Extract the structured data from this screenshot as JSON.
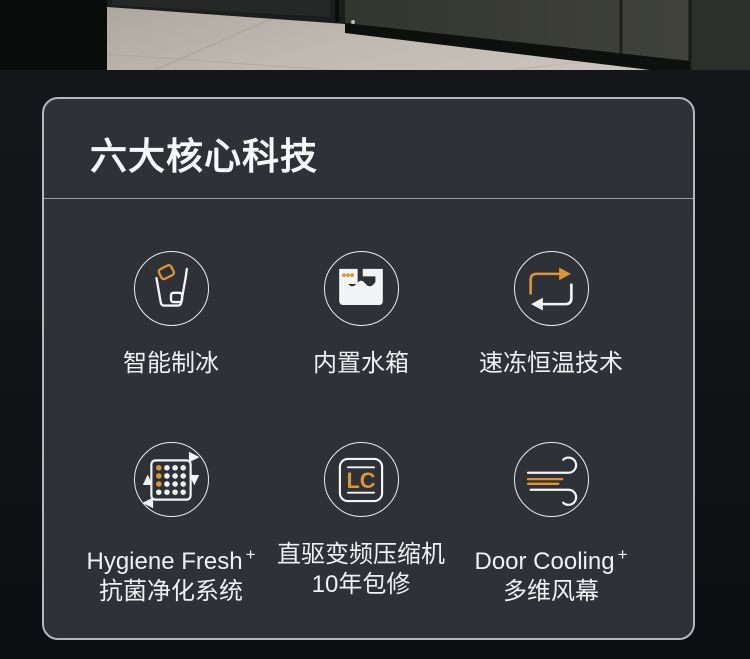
{
  "colors": {
    "accent_orange": "#dd9434",
    "icon_white": "#f2f4f5"
  },
  "section": {
    "title": "六大核心科技",
    "features": [
      {
        "name": "smart-ice-making",
        "icon": "ice-bucket-icon",
        "label": "智能制冰",
        "label_sup": "",
        "sub": ""
      },
      {
        "name": "built-in-water-tank",
        "icon": "water-tank-icon",
        "label": "内置水箱",
        "label_sup": "",
        "sub": ""
      },
      {
        "name": "quick-freeze-constant-temp",
        "icon": "cycle-arrows-icon",
        "label": "速冻恒温技术",
        "label_sup": "",
        "sub": ""
      },
      {
        "name": "hygiene-fresh-system",
        "icon": "air-filter-icon",
        "label": "Hygiene Fresh",
        "label_sup": "+",
        "sub": "抗菌净化系统"
      },
      {
        "name": "inverter-compressor",
        "icon": "lc-compressor-icon",
        "icon_text": "LC",
        "label": "直驱变频压缩机",
        "label_sup": "",
        "sub": "10年包修"
      },
      {
        "name": "door-cooling",
        "icon": "wind-icon",
        "label": "Door Cooling",
        "label_sup": "+",
        "sub": "多维风幕"
      }
    ]
  }
}
